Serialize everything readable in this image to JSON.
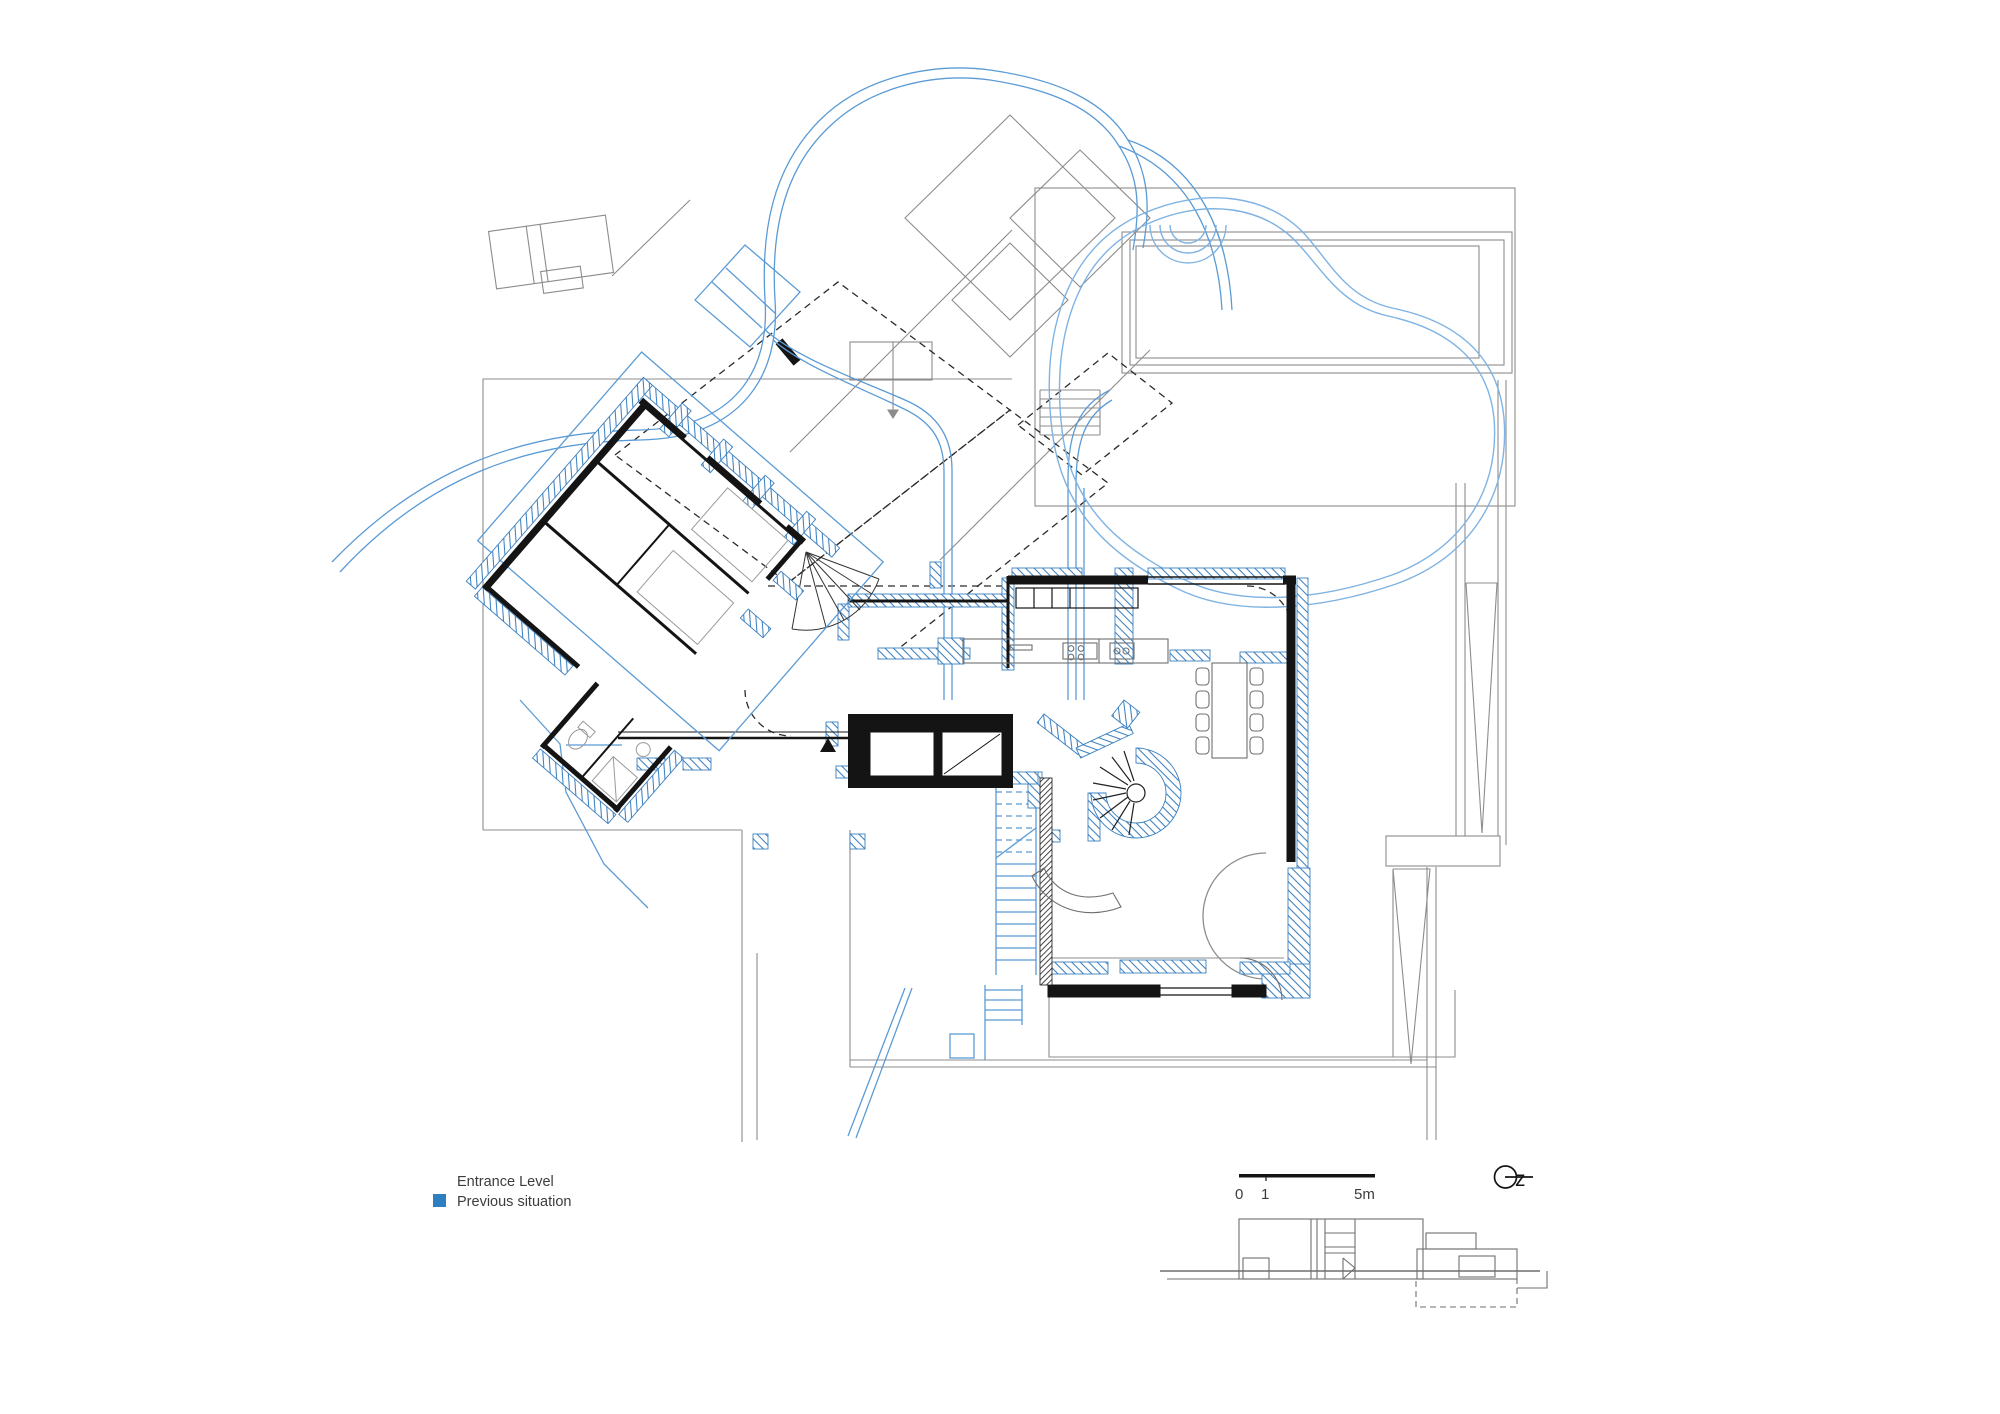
{
  "page": {
    "background": "#ffffff"
  },
  "colors": {
    "site_gray": "#8c8c8c",
    "structure_gray": "#6f6f6f",
    "furniture_gray": "#9a9a9a",
    "wall_black": "#141414",
    "dashed_black": "#2b2b2b",
    "previous_blue": "#5b9bd5",
    "pool_blue": "#7fb3e3",
    "hatch_blue": "#3c80c0",
    "text": "#3d3d3d"
  },
  "legend": {
    "level_label": "Entrance Level",
    "previous_label": "Previous situation",
    "previous_color": "#2e7fc1"
  },
  "scale_bar": {
    "start_label": "0",
    "mid_label": "1",
    "end_label": "5m"
  },
  "north": {
    "label": "z"
  }
}
